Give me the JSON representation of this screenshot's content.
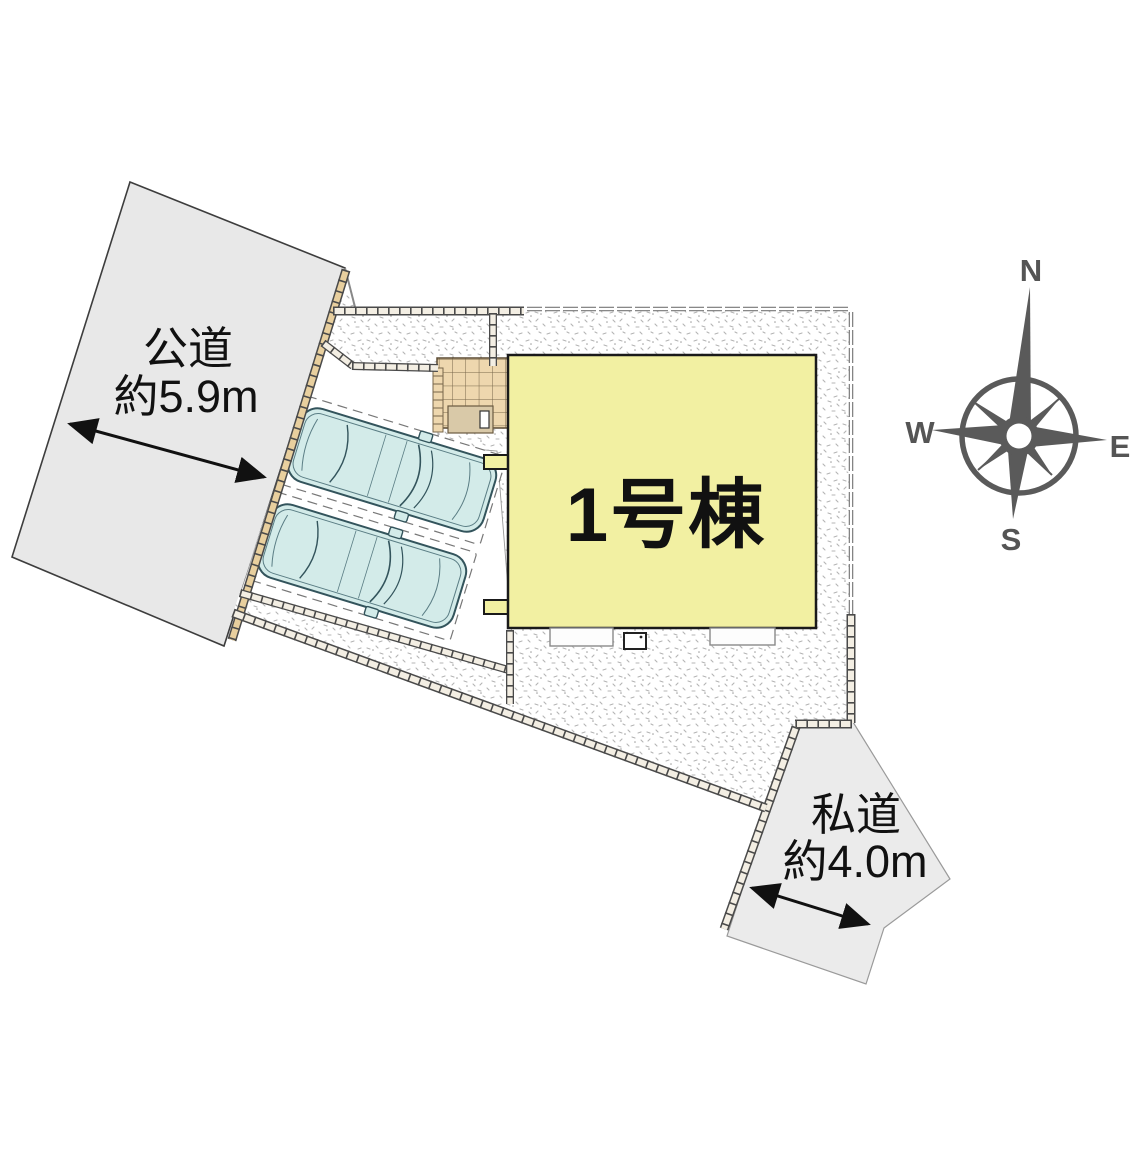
{
  "diagram": {
    "building": {
      "label": "1号棟"
    },
    "roads": {
      "public": {
        "name": "公道",
        "width_label": "約5.9m"
      },
      "private": {
        "name": "私道",
        "width_label": "約4.0m"
      }
    },
    "compass": {
      "north": "N",
      "east": "E",
      "south": "S",
      "west": "W"
    },
    "colors": {
      "building_fill": "#f2f0a2",
      "public_road_fill": "#e8e8e8",
      "private_road_fill": "#ebebeb",
      "car_fill": "#d3ebe9",
      "tile_fill": "#eed7ae",
      "compass_color": "#5a5a5a"
    }
  }
}
